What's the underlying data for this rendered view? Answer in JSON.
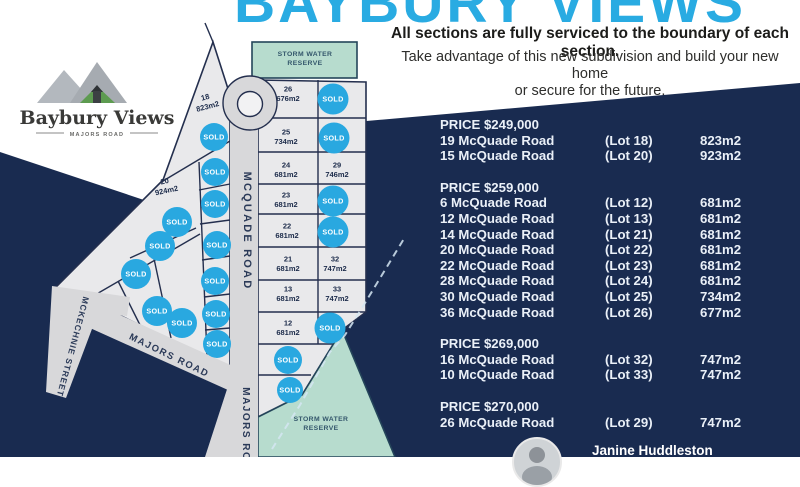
{
  "header": {
    "title": "BAYBURY VIEWS",
    "headline": "All sections are fully serviced to the boundary of each section.",
    "sub1": "Take advantage of this new subdivision and build your new home",
    "sub2": "or secure for the future."
  },
  "logo": {
    "name": "Baybury Views",
    "tagline": "MAJORS ROAD"
  },
  "map": {
    "sold_text": "SOLD",
    "sold_color": "#29a8e0",
    "road_labels": [
      {
        "text": "MCQUADE ROAD",
        "x": 244,
        "y": 231,
        "rotate": 90,
        "size": 11,
        "spacing": 2.2
      },
      {
        "text": "MAJORS ROAD",
        "x": 243,
        "y": 433,
        "rotate": 90,
        "size": 10,
        "spacing": 1.5
      },
      {
        "text": "MAJORS ROAD",
        "x": 168,
        "y": 358,
        "rotate": 26,
        "size": 9.5,
        "spacing": 1.5
      },
      {
        "text": "MCKECHNIE STREET",
        "x": 70,
        "y": 346,
        "rotate": 105,
        "size": 8.5,
        "spacing": 1
      }
    ],
    "reserve_labels": [
      {
        "line1": "STORM WATER",
        "line2": "RESERVE",
        "x": 305,
        "y": 56
      },
      {
        "line1": "STORM WATER",
        "line2": "RESERVE",
        "x": 321,
        "y": 421
      }
    ],
    "lot_labels": [
      {
        "n": "18",
        "a": "823m2",
        "x": 207,
        "y": 104,
        "rotate": -15
      },
      {
        "n": "20",
        "a": "924m2",
        "x": 166,
        "y": 188,
        "rotate": -12
      },
      {
        "n": "26",
        "a": "676m2",
        "x": 288,
        "y": 96,
        "rotate": 0
      },
      {
        "n": "25",
        "a": "734m2",
        "x": 286,
        "y": 139,
        "rotate": 0
      },
      {
        "n": "24",
        "a": "681m2",
        "x": 286,
        "y": 172,
        "rotate": 0
      },
      {
        "n": "29",
        "a": "746m2",
        "x": 337,
        "y": 172,
        "rotate": 0
      },
      {
        "n": "23",
        "a": "681m2",
        "x": 286,
        "y": 202,
        "rotate": 0
      },
      {
        "n": "22",
        "a": "681m2",
        "x": 287,
        "y": 233,
        "rotate": 0
      },
      {
        "n": "21",
        "a": "681m2",
        "x": 288,
        "y": 266,
        "rotate": 0
      },
      {
        "n": "32",
        "a": "747m2",
        "x": 335,
        "y": 266,
        "rotate": 0
      },
      {
        "n": "13",
        "a": "681m2",
        "x": 288,
        "y": 296,
        "rotate": 0
      },
      {
        "n": "33",
        "a": "747m2",
        "x": 337,
        "y": 296,
        "rotate": 0
      },
      {
        "n": "12",
        "a": "681m2",
        "x": 288,
        "y": 330,
        "rotate": 0
      }
    ],
    "sold_badges": [
      {
        "x": 333,
        "y": 99,
        "r": 15.5
      },
      {
        "x": 334,
        "y": 138,
        "r": 15.5
      },
      {
        "x": 333,
        "y": 201,
        "r": 15.5
      },
      {
        "x": 333,
        "y": 232,
        "r": 15.5
      },
      {
        "x": 330,
        "y": 328,
        "r": 15.5
      },
      {
        "x": 288,
        "y": 360,
        "r": 14
      },
      {
        "x": 290,
        "y": 390,
        "r": 13
      },
      {
        "x": 214,
        "y": 137,
        "r": 14
      },
      {
        "x": 215,
        "y": 172,
        "r": 14
      },
      {
        "x": 215,
        "y": 204,
        "r": 14
      },
      {
        "x": 217,
        "y": 245,
        "r": 14
      },
      {
        "x": 215,
        "y": 281,
        "r": 14
      },
      {
        "x": 216,
        "y": 314,
        "r": 14
      },
      {
        "x": 217,
        "y": 344,
        "r": 14
      },
      {
        "x": 177,
        "y": 222,
        "r": 15
      },
      {
        "x": 160,
        "y": 246,
        "r": 15
      },
      {
        "x": 136,
        "y": 274,
        "r": 15
      },
      {
        "x": 157,
        "y": 311,
        "r": 15
      },
      {
        "x": 182,
        "y": 323,
        "r": 15
      }
    ]
  },
  "price_list": {
    "sections": [
      {
        "price": "PRICE $249,000",
        "rows": [
          {
            "address": "19 McQuade Road",
            "lot": "(Lot 18)",
            "area": "823m2"
          },
          {
            "address": "15 McQuade Road",
            "lot": "(Lot 20)",
            "area": "923m2"
          }
        ]
      },
      {
        "price": "PRICE $259,000",
        "rows": [
          {
            "address": "6 McQuade Road",
            "lot": "(Lot 12)",
            "area": "681m2"
          },
          {
            "address": "12 McQuade Road",
            "lot": "(Lot 13)",
            "area": "681m2"
          },
          {
            "address": "14 McQuade Road",
            "lot": "(Lot 21)",
            "area": "681m2"
          },
          {
            "address": "20 McQuade Road",
            "lot": "(Lot 22)",
            "area": "681m2"
          },
          {
            "address": "22 McQuade Road",
            "lot": "(Lot 23)",
            "area": "681m2"
          },
          {
            "address": "28 McQuade Road",
            "lot": "(Lot 24)",
            "area": "681m2"
          },
          {
            "address": "30 McQuade Road",
            "lot": "(Lot 25)",
            "area": "734m2"
          },
          {
            "address": "36 McQuade Road",
            "lot": "(Lot 26)",
            "area": "677m2"
          }
        ]
      },
      {
        "price": "PRICE $269,000",
        "rows": [
          {
            "address": "16 McQuade Road",
            "lot": "(Lot 32)",
            "area": "747m2"
          },
          {
            "address": "10 McQuade Road",
            "lot": "(Lot 33)",
            "area": "747m2"
          }
        ]
      },
      {
        "price": "PRICE $270,000",
        "rows": [
          {
            "address": "26 McQuade Road",
            "lot": "(Lot 29)",
            "area": "747m2"
          }
        ]
      }
    ]
  },
  "agent": {
    "name": "Janine Huddleston"
  }
}
